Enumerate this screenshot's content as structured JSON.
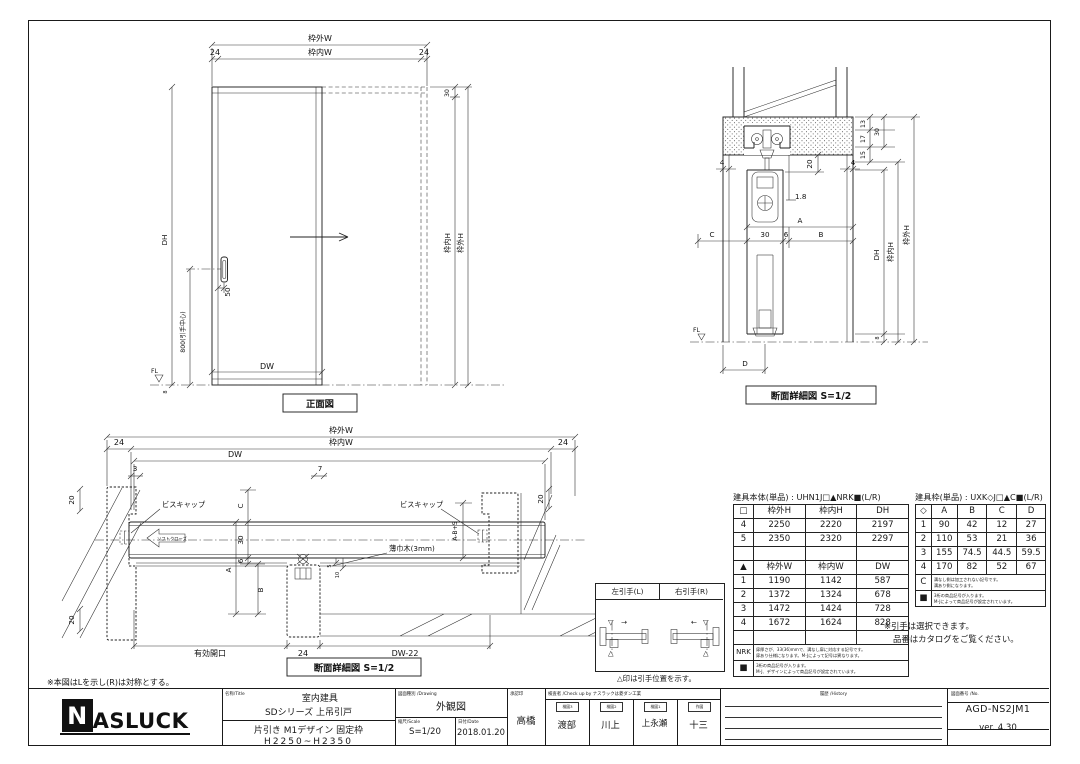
{
  "front_view": {
    "caption": "正面図",
    "dim_waku_gai_w": "枠外W",
    "dim_waku_uchi_w": "枠内W",
    "dim_24_left": "24",
    "dim_24_right": "24",
    "dim_30_top": "30",
    "dim_dh": "DH",
    "dim_800": "800(引手中心)",
    "dim_50": "50",
    "dim_dw": "DW",
    "dim_waku_uchi_h": "枠内H",
    "dim_waku_gai_h": "枠外H",
    "fl": "FL",
    "dim_8": "8"
  },
  "vertical_section": {
    "caption": "断面詳細図 S=1/2",
    "dim_4_left": "4",
    "dim_4_right": "4",
    "dim_20": "20",
    "dim_18": "1.8",
    "dim_13": "13",
    "dim_17": "17",
    "dim_15": "15",
    "dim_30_right": "30",
    "dim_a": "A",
    "dim_c": "C",
    "dim_30_door": "30",
    "dim_6": "6",
    "dim_b": "B",
    "dim_dh": "DH",
    "dim_waku_uchi_h": "枠内H",
    "dim_waku_gai_h": "枠外H",
    "dim_8": "8",
    "dim_d": "D",
    "fl": "FL"
  },
  "horizontal_section": {
    "caption": "断面詳細図 S=1/2",
    "note": "※本図はLを示し(R)は対称とする。",
    "dim_waku_gai_w": "枠外W",
    "dim_waku_uchi_w": "枠内W",
    "dim_24_left": "24",
    "dim_24_right": "24",
    "dim_dw": "DW",
    "dim_3": "3",
    "dim_7": "7",
    "dim_20_tl": "20",
    "dim_20_bl": "20",
    "dim_20_tr": "20",
    "label_biscap_left": "ビスキャップ",
    "label_biscap_right": "ビスキャップ",
    "label_softclose": "ソフトクローズ",
    "label_usubaki": "薄巾木(3mm)",
    "dim_c": "C",
    "dim_30": "30",
    "dim_6": "6",
    "dim_a": "A",
    "dim_b": "B",
    "dim_ab5": "A-B+5",
    "dim_5": "5",
    "dim_10": "10",
    "dim_yuko": "有効開口",
    "dim_24_bottom": "24",
    "dim_dw22": "DW-22"
  },
  "tables": {
    "body": {
      "caption": "建具本体(単品) : UHN1J□▲NRK■(L/R)",
      "h_header": [
        "□",
        "枠外H",
        "枠内H",
        "DH"
      ],
      "h_rows": [
        [
          "4",
          "2250",
          "2220",
          "2197"
        ],
        [
          "5",
          "2350",
          "2320",
          "2297"
        ]
      ],
      "w_header": [
        "▲",
        "枠外W",
        "枠内W",
        "DW"
      ],
      "w_rows": [
        [
          "1",
          "1190",
          "1142",
          "587"
        ],
        [
          "2",
          "1372",
          "1324",
          "678"
        ],
        [
          "3",
          "1472",
          "1424",
          "728"
        ],
        [
          "4",
          "1672",
          "1624",
          "828"
        ]
      ],
      "nrk_key": "NRK",
      "nrk_note_1": "扉厚さが、33(36)mmで、溝なし扉に対応する記号です。",
      "nrk_note_2": "扉あり仕様になります。M-Jによって記号は異なります。",
      "sq_key": "■",
      "sq_note_1": "3桁の商品記号が入ります。",
      "sq_note_2": "M-J、デザインによって商品記号が設定されています。"
    },
    "frame": {
      "caption": "建具枠(単品) : UXK◇J□▲C■(L/R)",
      "header": [
        "◇",
        "A",
        "B",
        "C",
        "D"
      ],
      "rows": [
        [
          "1",
          "90",
          "42",
          "12",
          "27"
        ],
        [
          "2",
          "110",
          "53",
          "21",
          "36"
        ],
        [
          "3",
          "155",
          "74.5",
          "44.5",
          "59.5"
        ],
        [
          "4",
          "170",
          "82",
          "52",
          "67"
        ]
      ],
      "c_key": "C",
      "c_note_1": "溝なし側は加工されない記号です。",
      "c_note_2": "溝あり側になります。",
      "sq_key": "■",
      "sq_note_1": "3桁の商品記号が入ります。",
      "sq_note_2": "M-Jによって商品記号が設定されています。"
    },
    "handle_box": {
      "left_header": "左引手(L)",
      "right_header": "右引手(R)",
      "sym_down": "▽",
      "sym_up": "△",
      "arrow_right": "→",
      "arrow_left": "←",
      "note": "△印は引手位置を示す。"
    },
    "handle_note_1": "※引手は選択できます。",
    "handle_note_2": "品番はカタログをご覧ください。"
  },
  "title_block": {
    "logo_n": "N",
    "logo_rest": "ASLUCK",
    "name_label": "名称/Title",
    "name_line1": "室内建具",
    "name_line2": "SDシリーズ 上吊引戸",
    "name_line3": "片引き M1デザイン 固定枠",
    "name_line4": "H2250~H2350",
    "drawing_label": "図面種別 /Drawing",
    "drawing_value": "外観図",
    "scale_label": "縮尺/Scale",
    "scale_value": "S=1/20",
    "date_label": "日付/Date",
    "date_value": "2018.01.20",
    "approve_label": "承認印",
    "approve_value": "高橋",
    "check_label": "検査者 /Check up by ナスラックは菱ダン工業",
    "check_cols": [
      {
        "label": "検図3",
        "value": "渡部"
      },
      {
        "label": "検図2",
        "value": "川上"
      },
      {
        "label": "検図1",
        "value": "上永瀬"
      },
      {
        "label": "作図",
        "value": "十三"
      }
    ],
    "history_label": "履歴 /History",
    "no_label": "図面番号 /No.",
    "no_value": "AGD-NS2JM1",
    "version": "ver. 4.30"
  }
}
